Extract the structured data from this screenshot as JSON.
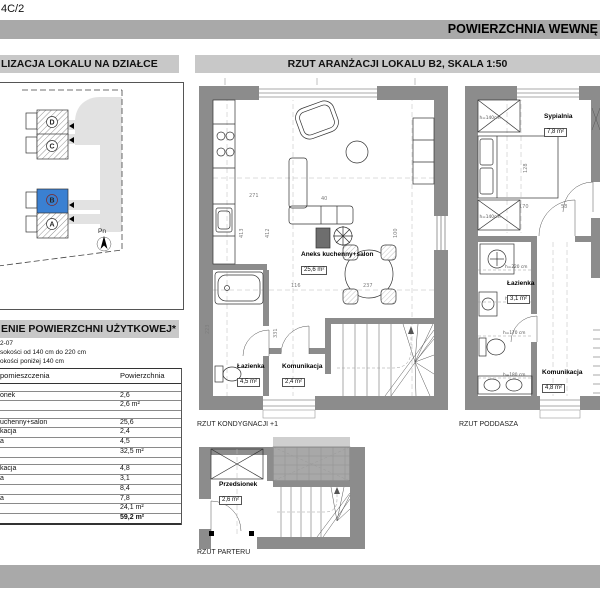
{
  "page": {
    "code": "4C/2",
    "banner": "POWIERZCHNIA WEWNĘ"
  },
  "site_panel": {
    "title": "LIZACJA LOKALU NA DZIAŁCE",
    "north": "Pn",
    "buildings": [
      {
        "id": "D"
      },
      {
        "id": "C"
      },
      {
        "id": "B",
        "highlighted": true
      },
      {
        "id": "A"
      }
    ]
  },
  "plans_panel": {
    "title": "RZUT ARANŻACJI LOKALU B2, SKALA 1:50"
  },
  "area_table": {
    "title": "ENIE POWIERZCHNI UŻYTKOWEJ*",
    "note1": "2-07",
    "note2": "sokości od 140 cm do 220 cm",
    "note3": "okości poniżej 140 cm",
    "col_room": "pomieszczenia",
    "col_area": "Powierzchnia",
    "rows": [
      {
        "label": "",
        "value": ""
      },
      {
        "label": "onek",
        "value": "2,6"
      },
      {
        "label": "",
        "value": "2,6 m²"
      },
      {
        "label": "",
        "value": ""
      },
      {
        "label": "uchenny+salon",
        "value": "25,6"
      },
      {
        "label": "kacja",
        "value": "2,4"
      },
      {
        "label": "a",
        "value": "4,5"
      },
      {
        "label": "",
        "value": "32,5 m²"
      },
      {
        "label": "",
        "value": ""
      },
      {
        "label": "kacja",
        "value": "4,8"
      },
      {
        "label": "a",
        "value": "3,1"
      },
      {
        "label": "",
        "value": "8,4"
      },
      {
        "label": "a",
        "value": "7,8"
      },
      {
        "label": "",
        "value": "24,1 m²"
      },
      {
        "label": "",
        "value": "59,2 m²"
      }
    ]
  },
  "floors": {
    "k1": {
      "caption": "RZUT KONDYGNACJI +1",
      "rooms": {
        "salon": {
          "name": "Aneks kuchenny+salon",
          "area": "25,6 m²"
        },
        "bath": {
          "name": "Łazienka",
          "area": "4,5 m²"
        },
        "hall": {
          "name": "Komunikacja",
          "area": "2,4 m²"
        }
      },
      "dims": {
        "d271": "271",
        "d413": "413",
        "d412": "412",
        "d116": "116",
        "d237": "237",
        "d40": "40",
        "d100": "100",
        "d223": "223",
        "d331": "331"
      }
    },
    "attic": {
      "caption": "RZUT PODDASZA",
      "rooms": {
        "bedroom": {
          "name": "Sypialnia",
          "area": "7,8 m²"
        },
        "bath": {
          "name": "Łazienka",
          "area": "3,1 m²"
        },
        "hall": {
          "name": "Komunikacja",
          "area": "4,8 m²"
        }
      },
      "dims": {
        "d170": "170",
        "d58": "58",
        "d128": "128",
        "h140a": "h=140cm",
        "h140b": "h=140cm",
        "h220": "h=220 cm",
        "h200": "h=200 cm",
        "h170": "h=170 cm",
        "h180": "h=180 cm"
      }
    },
    "ground": {
      "caption": "RZUT PARTERU",
      "rooms": {
        "entry": {
          "name": "Przedsionek",
          "area": "2,6 m²"
        }
      }
    }
  },
  "colors": {
    "banner_gray": "#a9a9a9",
    "header_gray": "#c8c8c8",
    "wall_gray": "#8c8c8c",
    "highlight_blue": "#3a80d2",
    "road_gray": "#e2e2e2"
  }
}
